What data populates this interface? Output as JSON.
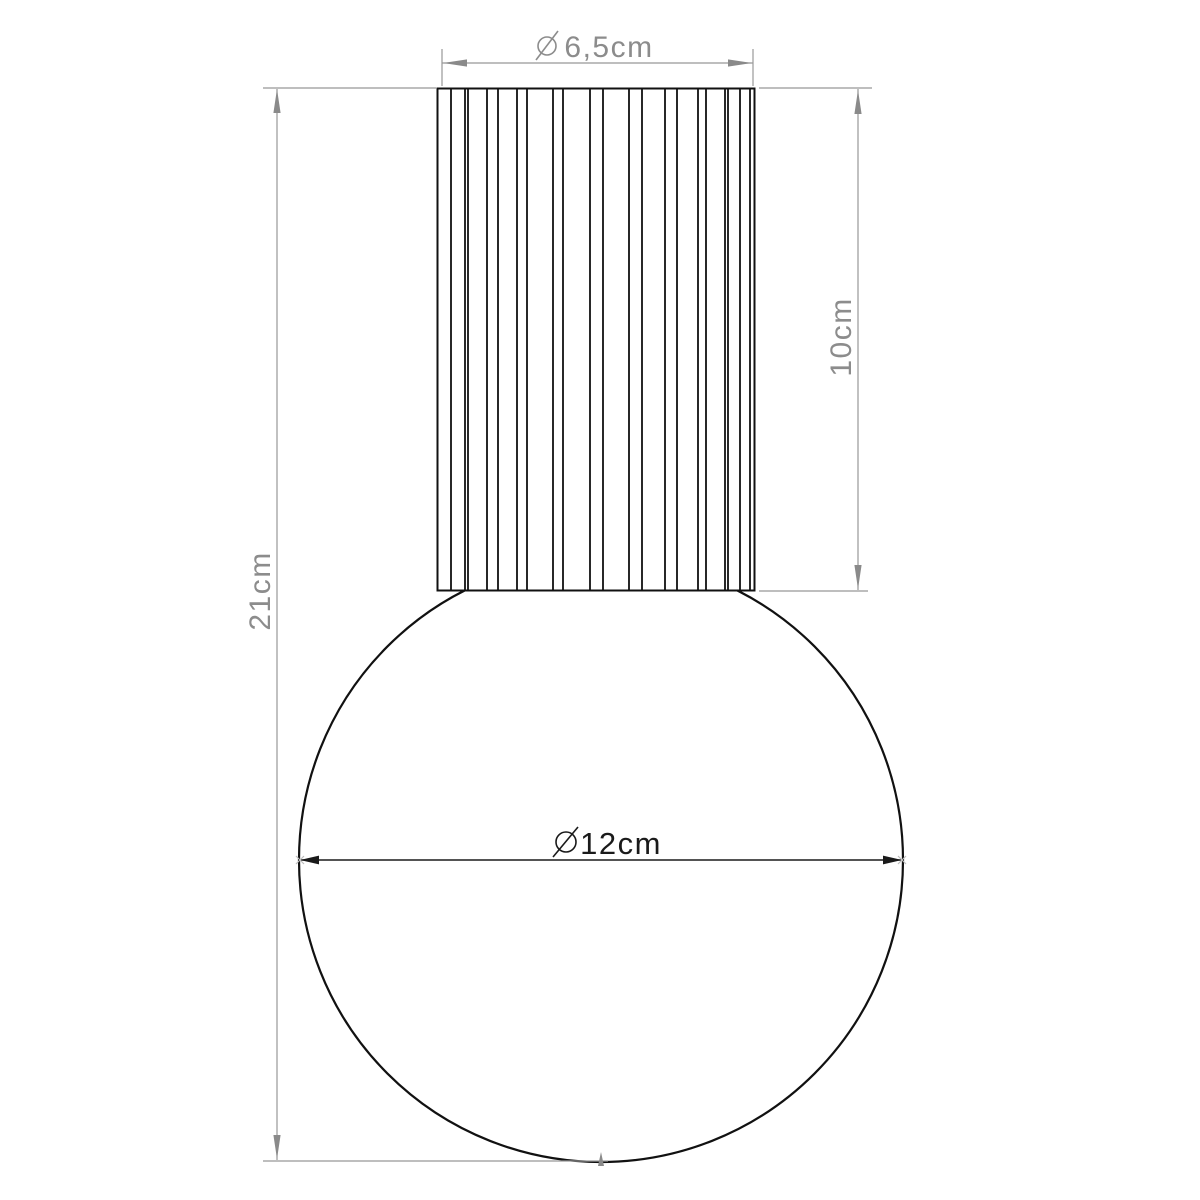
{
  "figure": {
    "kind": "technical-drawing",
    "background": "#ffffff"
  },
  "dimensions": {
    "top_diameter": {
      "symbol": "⌀",
      "label": "6,5cm",
      "value_cm": 6.5,
      "orientation": "horizontal",
      "color": "#8c8c8c"
    },
    "fitting_height": {
      "label": "10cm",
      "value_cm": 10,
      "orientation": "vertical",
      "color": "#8c8c8c"
    },
    "total_height": {
      "label": "21cm",
      "value_cm": 21,
      "orientation": "vertical",
      "color": "#8c8c8c"
    },
    "globe_diameter": {
      "symbol": "⌀",
      "label": "12cm",
      "value_cm": 12,
      "orientation": "horizontal",
      "color": "#1a1a1a"
    }
  },
  "colors": {
    "outline": "#111111",
    "dimension_gray": "#989898",
    "dimension_text_gray": "#8c8c8c",
    "dimension_dark": "#1a1a1a",
    "background": "#ffffff"
  }
}
